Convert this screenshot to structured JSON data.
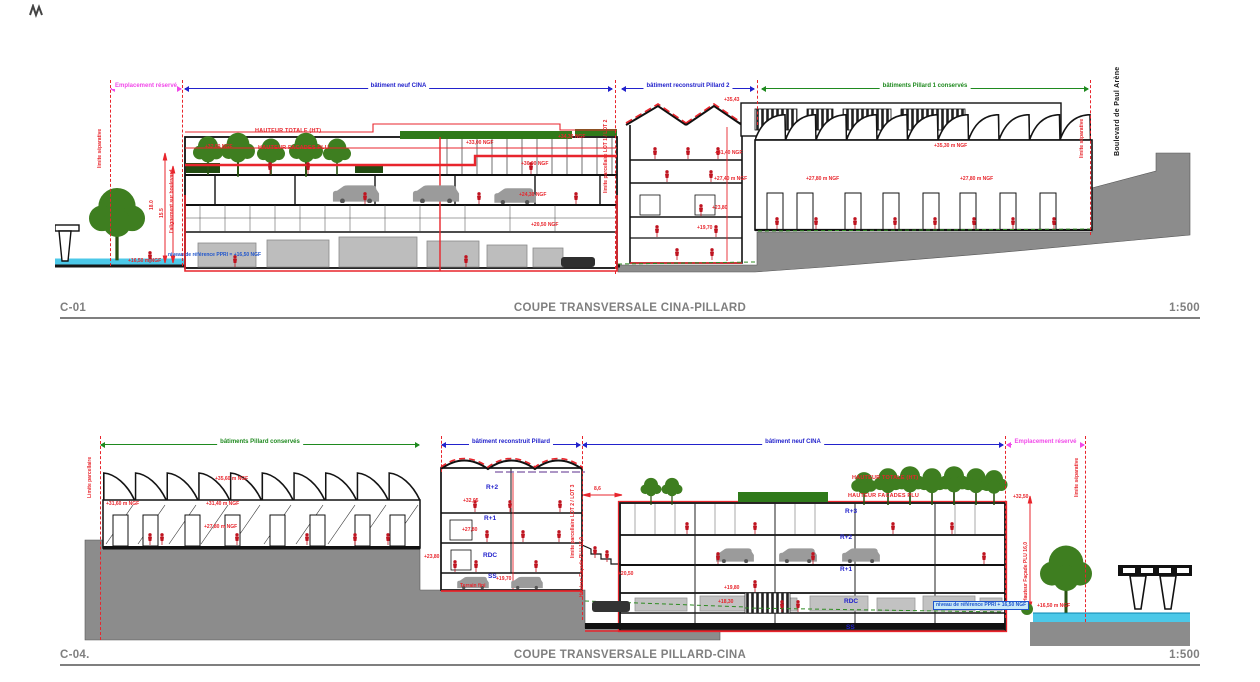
{
  "c01": {
    "ref": "C-01",
    "title": "COUPE TRANSVERSALE CINA-PILLARD",
    "scale": "1:500",
    "dims": [
      {
        "label": "Emplacement réservé"
      },
      {
        "label": "bâtiment neuf CINA"
      },
      {
        "label": "bâtiment reconstruit Pillard 2"
      },
      {
        "label": "bâtiments Pillard 1 conservés"
      }
    ],
    "boundaries": {
      "left": "limite séparative",
      "alignment": "l'alignement sur boulevard",
      "lot": "limite parcellaire LOT 1 / LOT 2",
      "right": "limite séparative",
      "street": "Boulevard de Paul Arène"
    },
    "height_refs": {
      "total": "HAUTEUR TOTALE (HT)",
      "facade": "HAUTEUR FACADES PLU"
    },
    "levels": [
      "+32,00 NGF",
      "+33,00 NGF",
      "+34,30 NGF",
      "+30,00 NGF",
      "+24,30 NGF",
      "+20,50 NGF",
      "+35,43",
      "+31,40 NGF",
      "+27,40 m NGF",
      "+23,80",
      "+19,70",
      "+35,30 m NGF",
      "+27,80 m NGF",
      "+27,80 m NGF",
      "+16,50 m NGF"
    ],
    "vertical_dims": [
      "18.0",
      "15.5"
    ],
    "ppri": "niveau de référence PPRI = +16,50 NGF"
  },
  "c04": {
    "ref": "C-04.",
    "title": "COUPE TRANSVERSALE PILLARD-CINA",
    "scale": "1:500",
    "dims": [
      {
        "label": "bâtiments Pillard conservés"
      },
      {
        "label": "bâtiment reconstruit Pillard"
      },
      {
        "label": "bâtiment neuf CINA"
      },
      {
        "label": "Emplacement réservé"
      }
    ],
    "boundaries": {
      "left": "Limite parcellaire",
      "lot": "limite parcellaire LOT 2 / LOT 3",
      "right": "limite séparative"
    },
    "height_refs": {
      "total": "HAUTEUR TOTALE (HT)",
      "facade": "HAUTEUR FACADES PLU",
      "facade_plu_left": "Hauteur Façade PLU 16,0",
      "facade_plu_right": "Hauteur Façade PLU 16,0"
    },
    "floors_pillard": [
      "R+2",
      "R+1",
      "RDC",
      "SS"
    ],
    "floors_cina": [
      "R+3",
      "R+2",
      "R+1",
      "RDC",
      "SS"
    ],
    "levels": [
      "+35,60 m NGF",
      "+31,60 m NGF",
      "+31,40 m NGF",
      "+27,80 m NGF",
      "+32,05",
      "+27,80",
      "+23,80",
      "+19,70",
      "Terrain fini",
      "+20,50",
      "+19,80",
      "+18,30",
      "+32,50",
      "+16,50 m NGF"
    ],
    "dim_width": "8,6",
    "ppri": "niveau de référence PPRI + 16,50 NGF"
  }
}
